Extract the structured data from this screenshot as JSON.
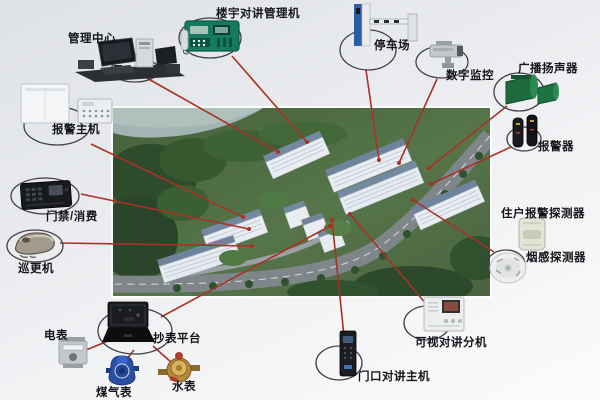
{
  "colors": {
    "connection_line": "#a93226",
    "background": "#e9ebee",
    "intercom_green": "#157a60",
    "speaker_green": "#1d6b3c",
    "label_text": "#141619"
  },
  "center": {
    "id": "residential-complex",
    "icon": "aerial-view-residential-complex"
  },
  "nodes": [
    {
      "id": "management-center",
      "label": "管理中心",
      "icon": "computer-workstation-icon"
    },
    {
      "id": "building-intercom-manager",
      "label": "楼宇对讲管理机",
      "icon": "intercom-manager-icon"
    },
    {
      "id": "parking-lot",
      "label": "停车场",
      "icon": "barrier-gate-icon"
    },
    {
      "id": "digital-surveillance",
      "label": "数字监控",
      "icon": "ptz-camera-icon"
    },
    {
      "id": "broadcast-speaker",
      "label": "广播扬声器",
      "icon": "horn-speaker-icon"
    },
    {
      "id": "alarm-siren",
      "label": "报警器",
      "icon": "siren-icon"
    },
    {
      "id": "alarm-host",
      "label": "报警主机",
      "icon": "alarm-panel-icon"
    },
    {
      "id": "access-control",
      "label": "门禁/消费",
      "icon": "card-reader-icon"
    },
    {
      "id": "patrol-reader",
      "label": "巡更机",
      "icon": "patrol-reader-icon"
    },
    {
      "id": "electric-meter",
      "label": "电表",
      "icon": "electric-meter-icon"
    },
    {
      "id": "meter-reading-platform",
      "label": "抄表平台",
      "icon": "meter-platform-icon"
    },
    {
      "id": "gas-meter",
      "label": "煤气表",
      "icon": "gas-meter-icon"
    },
    {
      "id": "water-meter",
      "label": "水表",
      "icon": "water-meter-icon"
    },
    {
      "id": "door-intercom-host",
      "label": "门口对讲主机",
      "icon": "door-station-icon"
    },
    {
      "id": "video-intercom-extension",
      "label": "可视对讲分机",
      "icon": "indoor-monitor-icon"
    },
    {
      "id": "resident-alarm-detector",
      "label": "住户报警探测器",
      "icon": "pir-detector-icon"
    },
    {
      "id": "smoke-detector",
      "label": "烟感探测器",
      "icon": "smoke-detector-icon"
    }
  ],
  "connections": [
    {
      "from": "management-center",
      "to": "residential-complex",
      "x1": 145,
      "y1": 77,
      "x2": 278,
      "y2": 152
    },
    {
      "from": "building-intercom-manager",
      "to": "residential-complex",
      "x1": 232,
      "y1": 56,
      "x2": 307,
      "y2": 142
    },
    {
      "from": "parking-lot",
      "to": "residential-complex",
      "x1": 366,
      "y1": 70,
      "x2": 379,
      "y2": 160
    },
    {
      "from": "digital-surveillance",
      "to": "residential-complex",
      "x1": 437,
      "y1": 79,
      "x2": 399,
      "y2": 163
    },
    {
      "from": "broadcast-speaker",
      "to": "residential-complex",
      "x1": 507,
      "y1": 106,
      "x2": 429,
      "y2": 168
    },
    {
      "from": "alarm-siren",
      "to": "residential-complex",
      "x1": 511,
      "y1": 147,
      "x2": 431,
      "y2": 184
    },
    {
      "from": "alarm-host",
      "to": "residential-complex",
      "x1": 91,
      "y1": 144,
      "x2": 243,
      "y2": 217
    },
    {
      "from": "access-control",
      "to": "residential-complex",
      "x1": 81,
      "y1": 194,
      "x2": 249,
      "y2": 229
    },
    {
      "from": "patrol-reader",
      "to": "residential-complex",
      "x1": 60,
      "y1": 243,
      "x2": 252,
      "y2": 246
    },
    {
      "from": "meter-reading-platform",
      "to": "residential-complex",
      "x1": 161,
      "y1": 317,
      "x2": 330,
      "y2": 226
    },
    {
      "from": "door-intercom-host",
      "to": "residential-complex",
      "x1": 344,
      "y1": 336,
      "x2": 332,
      "y2": 220
    },
    {
      "from": "video-intercom-extension",
      "to": "residential-complex",
      "x1": 427,
      "y1": 305,
      "x2": 350,
      "y2": 214
    },
    {
      "from": "smoke-detector",
      "to": "residential-complex",
      "x1": 494,
      "y1": 252,
      "x2": 413,
      "y2": 200
    },
    {
      "from": "electric-meter",
      "to": "meter-reading-platform",
      "x1": 86,
      "y1": 350,
      "x2": 108,
      "y2": 341
    },
    {
      "from": "gas-meter",
      "to": "meter-reading-platform",
      "x1": 126,
      "y1": 360,
      "x2": 134,
      "y2": 350
    },
    {
      "from": "water-meter",
      "to": "meter-reading-platform",
      "x1": 172,
      "y1": 363,
      "x2": 153,
      "y2": 346
    }
  ]
}
